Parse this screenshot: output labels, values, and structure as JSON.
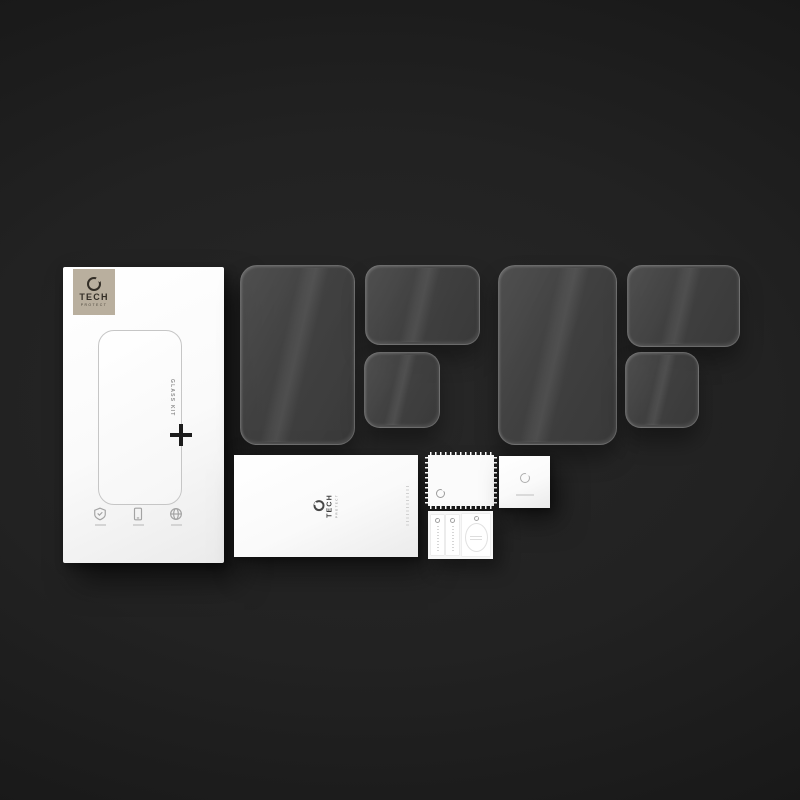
{
  "image_type": "product-photo",
  "subject": "TECH PROTECT Glass Kit - tempered glass screen protector set with installation accessories on dark background",
  "brand": {
    "name_primary": "TECH",
    "name_secondary": "PROTECT"
  },
  "box": {
    "glass_kit_label": "GLASS KIT"
  },
  "colors": {
    "background_center": "#272727",
    "background_edge": "#121212",
    "badge_beige": "#b9af9e",
    "badge_text": "#332e26",
    "glass_fill": "#4a4a4a",
    "glass_edge": "#9e9e9e",
    "card_white": "#fbfbfb",
    "cross_black": "#1c1c1c"
  },
  "icons": [
    "broken-ring-logo-icon",
    "shield-icon",
    "smartphone-icon",
    "globe-icon",
    "alignment-cross-icon"
  ],
  "items": {
    "glass_panels": [
      "large-left",
      "medium-left",
      "small-left",
      "large-right",
      "medium-right",
      "small-right"
    ],
    "accessories": [
      "instruction-envelope",
      "wet-wipe-sachet",
      "microfiber-square",
      "wipe-and-sticker-kit"
    ]
  }
}
